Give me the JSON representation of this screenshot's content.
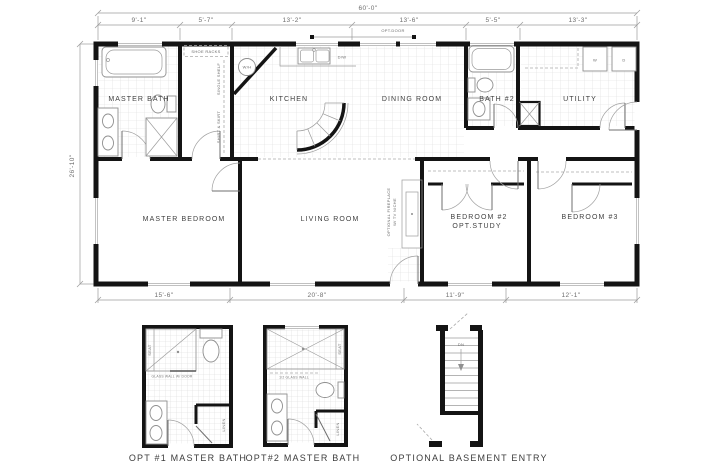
{
  "plan": {
    "overall_width": "60'-0\"",
    "overall_depth": "26'-10\"",
    "top_dims": [
      "9'-1\"",
      "5'-7\"",
      "13'-2\"",
      "13'-6\"",
      "5'-5\"",
      "13'-3\""
    ],
    "bottom_dims": [
      "15'-6\"",
      "20'-8\"",
      "11'-9\"",
      "12'-1\""
    ],
    "rooms": {
      "master_bath": "MASTER BATH",
      "kitchen": "KITCHEN",
      "dining": "DINING ROOM",
      "bath2": "BATH #2",
      "utility": "UTILITY",
      "master_bedroom": "MASTER BEDROOM",
      "living": "LIVING ROOM",
      "bedroom2": "BEDROOM #2",
      "bedroom2_opt": "OPT.STUDY",
      "bedroom3": "BEDROOM #3"
    },
    "notes": {
      "shoe_racks": "SHOE RACKS",
      "single_shelf": "SINGLE SHELF",
      "shirt_skirt": "SHIRT & SKIRT",
      "water_heater": "W/H",
      "dishwasher": "D/W",
      "washer": "W",
      "dryer": "D",
      "opt_door": "OPT.DOOR",
      "fireplace1": "OPTIONAL FIREPLACE",
      "fireplace2": "W/ TV NICHE"
    }
  },
  "details": {
    "opt1": {
      "title": "OPT #1 MASTER BATH",
      "seat": "SEAT",
      "glass_wall": "GLASS WALL W/ DOOR",
      "linen": "LINEN"
    },
    "opt2": {
      "title": "OPT#2 MASTER BATH",
      "seat": "SEAT",
      "glass_wall": "1/2 GLASS WALL",
      "linen": "LINEN"
    },
    "basement": {
      "title": "OPTIONAL BASEMENT ENTRY",
      "down": "DN"
    }
  },
  "colors": {
    "wall": "#141414",
    "thin_line": "#9b9b9b",
    "tile_line": "#d8d8d8",
    "label_text": "#4a4a4a",
    "dim_text": "#6e6e6e"
  }
}
